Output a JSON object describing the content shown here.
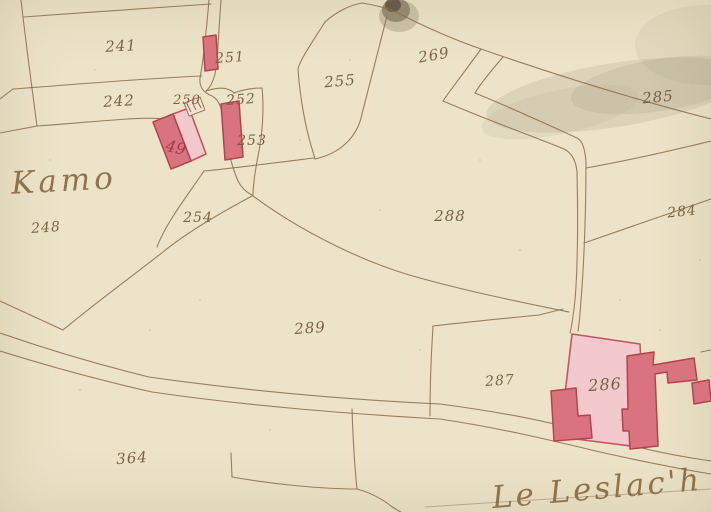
{
  "map": {
    "type": "historical cadastral map",
    "places": [
      {
        "id": "kamo",
        "text": "Kamo"
      },
      {
        "id": "le_leslach",
        "text": "Le Leslac'h"
      }
    ],
    "parcels": [
      {
        "id": "241",
        "text": "241"
      },
      {
        "id": "242",
        "text": "242"
      },
      {
        "id": "248",
        "text": "248"
      },
      {
        "id": "250",
        "text": "250"
      },
      {
        "id": "251",
        "text": "251"
      },
      {
        "id": "252",
        "text": "252"
      },
      {
        "id": "253",
        "text": "253"
      },
      {
        "id": "254",
        "text": "254"
      },
      {
        "id": "255",
        "text": "255"
      },
      {
        "id": "269",
        "text": "269"
      },
      {
        "id": "284",
        "text": "284"
      },
      {
        "id": "285",
        "text": "285"
      },
      {
        "id": "286",
        "text": "286"
      },
      {
        "id": "287",
        "text": "287"
      },
      {
        "id": "288",
        "text": "288"
      },
      {
        "id": "289",
        "text": "289"
      },
      {
        "id": "364",
        "text": "364"
      }
    ],
    "building_labels": [
      {
        "id": "49",
        "text": "49"
      }
    ],
    "colors": {
      "paper": "#ece3c8",
      "boundary_ink": "#8b6d49",
      "label_ink": "#74593a",
      "building_fill": "#d9737f",
      "building_stroke": "#b5434f",
      "courtyard_pink": "#f2cacc",
      "red_ink": "#a63a46",
      "stain_wash": "#a49c85"
    }
  }
}
